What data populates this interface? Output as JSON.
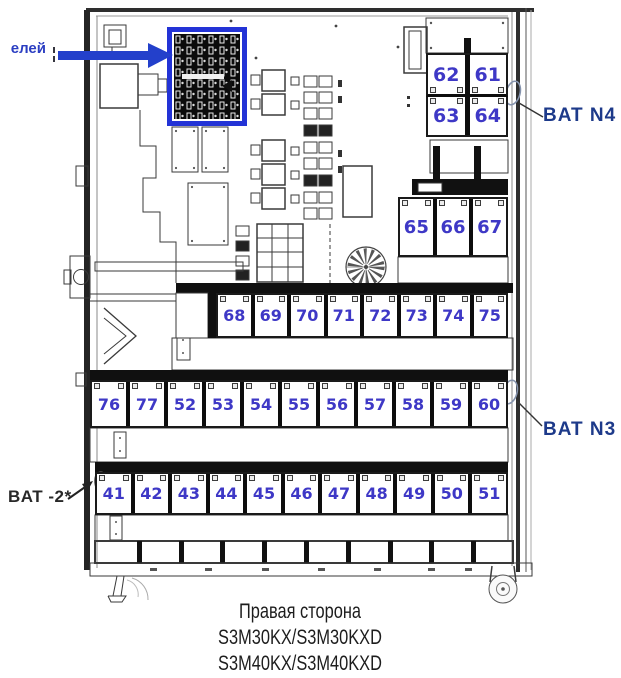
{
  "labels": {
    "fuse_pointer": "елей",
    "bat_n4": "BAT N4",
    "bat_n3": "BAT N3",
    "bat_minus2": "BAT -2*"
  },
  "batteries": {
    "block_n4_top": [
      "62",
      "61"
    ],
    "block_n4_bottom": [
      "63",
      "64"
    ],
    "block_mid": [
      "65",
      "66",
      "67"
    ],
    "row_upper": [
      "68",
      "69",
      "70",
      "71",
      "72",
      "73",
      "74",
      "75"
    ],
    "row_middle": [
      "76",
      "77",
      "52",
      "53",
      "54",
      "55",
      "56",
      "57",
      "58",
      "59",
      "60"
    ],
    "row_lower": [
      "41",
      "42",
      "43",
      "44",
      "45",
      "46",
      "47",
      "48",
      "49",
      "50",
      "51"
    ]
  },
  "caption": {
    "line1": "Правая сторона",
    "line2": "S3M30KX/S3M30KXD",
    "line3": "S3M40KX/S3M40KXD"
  },
  "colors": {
    "battery_number": "#3e38c6",
    "callout_label_blue": "#1d3a8a",
    "callout_label_dark": "#282828",
    "highlight_blue": "#2340cb",
    "line_art": "#3a3a3a"
  }
}
